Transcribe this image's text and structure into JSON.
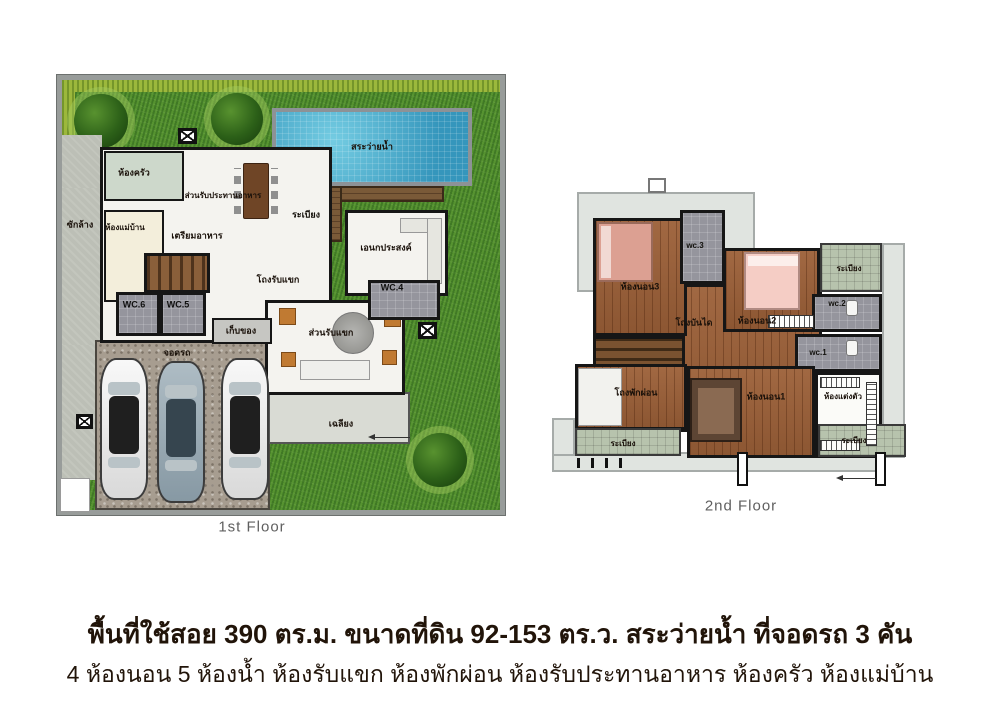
{
  "floor1": {
    "caption": "1st Floor",
    "labels": {
      "pool": "สระว่ายน้ำ",
      "terrace": "ระเบียง",
      "kitchen": "ห้องครัว",
      "dining": "ส่วนรับประทานอาหาร",
      "prep": "เตรียมอาหาร",
      "laundry": "ซักล้าง",
      "maid_room": "ห้องแม่บ้าน",
      "living_hall": "โถงรับแขก",
      "multipurpose": "เอนกประสงค์",
      "wc4": "WC.4",
      "wc5": "WC.5",
      "wc6": "WC.6",
      "storage": "เก็บของ",
      "parking": "จอดรถ",
      "guest_corner": "ส่วนรับแขก",
      "porch": "เฉลียง"
    }
  },
  "floor2": {
    "caption": "2nd Floor",
    "labels": {
      "bedroom3": "ห้องนอน3",
      "wc3": "wc.3",
      "bedroom2": "ห้องนอน2",
      "balcony_top": "ระเบียง",
      "wc2": "wc.2",
      "stair_hall": "โถงบันได",
      "wc1": "wc.1",
      "lounge_hall": "โถงพักผ่อน",
      "bedroom1": "ห้องนอน1",
      "dressing_room": "ห้องแต่งตัว",
      "balcony_left": "ระเบียง",
      "balcony_right": "ระเบียง"
    }
  },
  "description": {
    "line1": "พื้นที่ใช้สอย 390 ตร.ม. ขนาดที่ดิน 92-153 ตร.ว.  สระว่ายน้ำ ที่จอดรถ 3 คัน",
    "line2": "4 ห้องนอน 5 ห้องน้ำ  ห้องรับแขก ห้องพักผ่อน ห้องรับประทานอาหาร ห้องครัว ห้องแม่บ้าน"
  },
  "colors": {
    "grass_green": "#4e8c2e",
    "pool_water": "#3ea6c8",
    "deck_wood": "#7a5a38",
    "upper_floor_wood": "#9c6038",
    "roof_gray": "#e0e4e0",
    "balcony_tile": "#b7c3ad",
    "wall_black": "#161616",
    "caption_gray": "#5f5f5f",
    "text_dark_brown": "#211409"
  }
}
